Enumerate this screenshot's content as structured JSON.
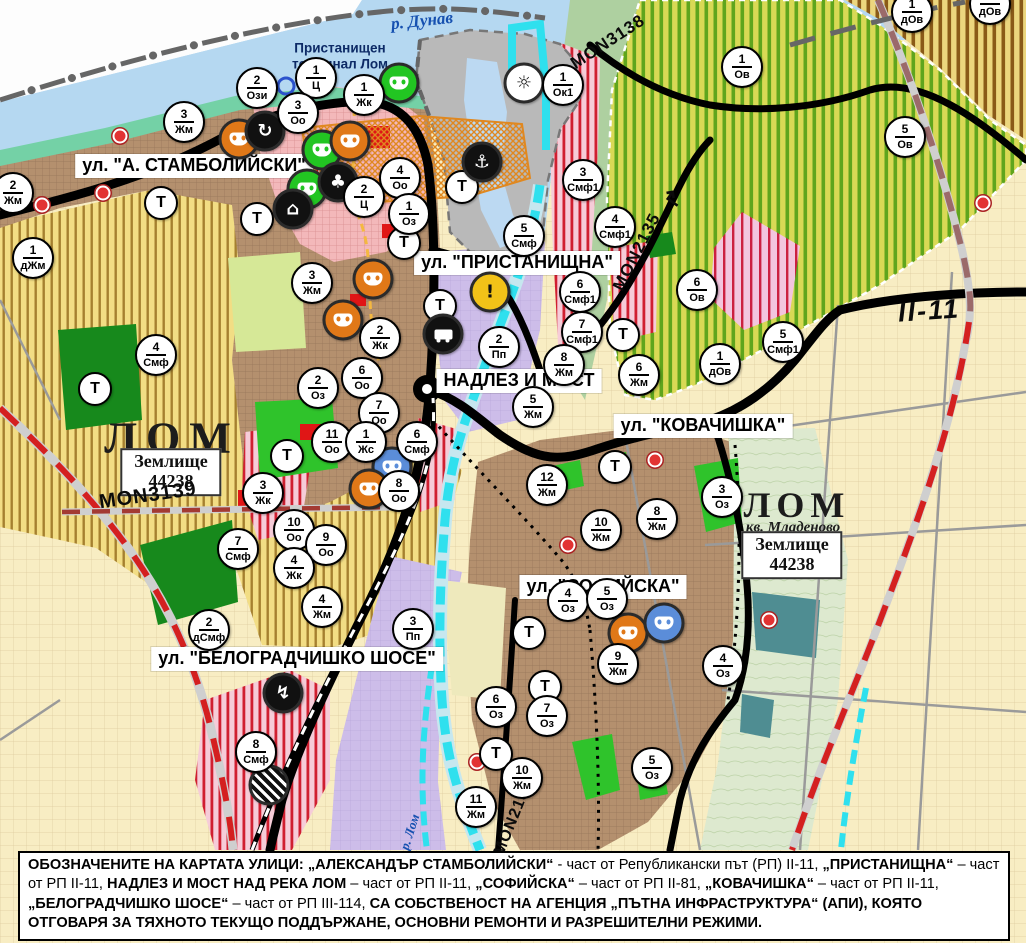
{
  "map_meta": {
    "danube_label": "р. Дунав",
    "river_lom_label": "р. Лом",
    "port_label_line1": "Пристанищен",
    "port_label_line2": "терминал Лом",
    "city_west": "ЛОМ",
    "city_east": "ЛОМ",
    "quarter_east": "кв. Младеново",
    "landplot_line1": "Землище",
    "landplot_line2": "44238",
    "t_symbol": "Т"
  },
  "street_labels": [
    {
      "text": "ул. \"А. СТАМБОЛИЙСКИ\"",
      "x": 194,
      "y": 166
    },
    {
      "text": "ул. \"ПРИСТАНИЩНА\"",
      "x": 517,
      "y": 263
    },
    {
      "text": "НАДЛЕЗ И МОСТ",
      "x": 519,
      "y": 381
    },
    {
      "text": "ул. \"КОВАЧИШКА\"",
      "x": 703,
      "y": 426
    },
    {
      "text": "ул. \"СОФИЙСКА\"",
      "x": 603,
      "y": 587
    },
    {
      "text": "ул. \"БЕЛОГРАДЧИШКО ШОСЕ\"",
      "x": 297,
      "y": 659
    }
  ],
  "road_labels": [
    {
      "text": "MON3138",
      "x": 608,
      "y": 42,
      "rot": -33,
      "size": 17
    },
    {
      "text": "MON2135",
      "x": 637,
      "y": 252,
      "rot": -63,
      "size": 17
    },
    {
      "text": "↱",
      "x": 674,
      "y": 198,
      "rot": -55,
      "size": 22
    },
    {
      "text": "MON3139",
      "x": 148,
      "y": 496,
      "rot": -8,
      "size": 20
    },
    {
      "text": "MON2136",
      "x": 514,
      "y": 818,
      "rot": -68,
      "size": 16
    },
    {
      "text": "II-11",
      "x": 929,
      "y": 311,
      "rot": -4,
      "size": 27,
      "big": true
    }
  ],
  "zone_markers": [
    {
      "num": "2",
      "code": "Жм",
      "x": 13,
      "y": 193
    },
    {
      "num": "3",
      "code": "Жм",
      "x": 184,
      "y": 122
    },
    {
      "num": "2",
      "code": "Ози",
      "x": 257,
      "y": 88
    },
    {
      "num": "1",
      "code": "Ц",
      "x": 316,
      "y": 78
    },
    {
      "num": "3",
      "code": "Оо",
      "x": 298,
      "y": 113
    },
    {
      "num": "1",
      "code": "Жк",
      "x": 364,
      "y": 95
    },
    {
      "num": "4",
      "code": "Оо",
      "x": 400,
      "y": 178
    },
    {
      "num": "2",
      "code": "Ц",
      "x": 364,
      "y": 197
    },
    {
      "num": "1",
      "code": "Оз",
      "x": 409,
      "y": 214
    },
    {
      "num": "1",
      "code": "Ок1",
      "x": 563,
      "y": 85
    },
    {
      "num": "3",
      "code": "Смф1",
      "x": 583,
      "y": 180
    },
    {
      "num": "4",
      "code": "Смф1",
      "x": 615,
      "y": 227
    },
    {
      "num": "5",
      "code": "Смф",
      "x": 524,
      "y": 236
    },
    {
      "num": "6",
      "code": "Смф1",
      "x": 580,
      "y": 292
    },
    {
      "num": "7",
      "code": "Смф1",
      "x": 582,
      "y": 332
    },
    {
      "num": "6",
      "code": "Ов",
      "x": 697,
      "y": 290
    },
    {
      "num": "1",
      "code": "Ов",
      "x": 742,
      "y": 67
    },
    {
      "num": "5",
      "code": "Ов",
      "x": 905,
      "y": 137
    },
    {
      "num": "1",
      "code": "дОв",
      "x": 912,
      "y": 12
    },
    {
      "num": "1",
      "code": "дОв",
      "x": 990,
      "y": 4
    },
    {
      "num": "1",
      "code": "дЖм",
      "x": 33,
      "y": 258
    },
    {
      "num": "4",
      "code": "Смф",
      "x": 156,
      "y": 355
    },
    {
      "num": "3",
      "code": "Жм",
      "x": 312,
      "y": 283
    },
    {
      "num": "2",
      "code": "Жк",
      "x": 380,
      "y": 338
    },
    {
      "num": "6",
      "code": "Оо",
      "x": 362,
      "y": 378
    },
    {
      "num": "2",
      "code": "Оз",
      "x": 318,
      "y": 388
    },
    {
      "num": "7",
      "code": "Оо",
      "x": 379,
      "y": 413
    },
    {
      "num": "11",
      "code": "Оо",
      "x": 332,
      "y": 442
    },
    {
      "num": "1",
      "code": "Жс",
      "x": 366,
      "y": 442
    },
    {
      "num": "6",
      "code": "Смф",
      "x": 417,
      "y": 442
    },
    {
      "num": "8",
      "code": "Оо",
      "x": 399,
      "y": 491
    },
    {
      "num": "3",
      "code": "Жк",
      "x": 263,
      "y": 493
    },
    {
      "num": "2",
      "code": "Пп",
      "x": 499,
      "y": 347
    },
    {
      "num": "5",
      "code": "Жм",
      "x": 533,
      "y": 407
    },
    {
      "num": "8",
      "code": "Жм",
      "x": 564,
      "y": 365
    },
    {
      "num": "6",
      "code": "Жм",
      "x": 639,
      "y": 375
    },
    {
      "num": "1",
      "code": "дОв",
      "x": 720,
      "y": 364
    },
    {
      "num": "5",
      "code": "Смф1",
      "x": 783,
      "y": 342
    },
    {
      "num": "10",
      "code": "Оо",
      "x": 294,
      "y": 530
    },
    {
      "num": "9",
      "code": "Оо",
      "x": 326,
      "y": 545
    },
    {
      "num": "4",
      "code": "Жк",
      "x": 294,
      "y": 568
    },
    {
      "num": "7",
      "code": "Смф",
      "x": 238,
      "y": 549
    },
    {
      "num": "4",
      "code": "Жм",
      "x": 322,
      "y": 607
    },
    {
      "num": "3",
      "code": "Пп",
      "x": 413,
      "y": 629
    },
    {
      "num": "2",
      "code": "дСмф",
      "x": 209,
      "y": 630
    },
    {
      "num": "8",
      "code": "Смф",
      "x": 256,
      "y": 752
    },
    {
      "num": "12",
      "code": "Жм",
      "x": 547,
      "y": 485
    },
    {
      "num": "10",
      "code": "Жм",
      "x": 601,
      "y": 530
    },
    {
      "num": "8",
      "code": "Жм",
      "x": 657,
      "y": 519
    },
    {
      "num": "3",
      "code": "Оз",
      "x": 722,
      "y": 497
    },
    {
      "num": "9",
      "code": "Жм",
      "x": 618,
      "y": 664
    },
    {
      "num": "4",
      "code": "Оз",
      "x": 723,
      "y": 666
    },
    {
      "num": "4",
      "code": "Оз",
      "x": 568,
      "y": 601
    },
    {
      "num": "5",
      "code": "Оз",
      "x": 607,
      "y": 599
    },
    {
      "num": "6",
      "code": "Оз",
      "x": 496,
      "y": 707
    },
    {
      "num": "7",
      "code": "Оз",
      "x": 547,
      "y": 716
    },
    {
      "num": "5",
      "code": "Оз",
      "x": 652,
      "y": 768
    },
    {
      "num": "10",
      "code": "Жм",
      "x": 522,
      "y": 778
    },
    {
      "num": "11",
      "code": "Жм",
      "x": 476,
      "y": 807
    }
  ],
  "t_markers": [
    {
      "x": 161,
      "y": 203
    },
    {
      "x": 257,
      "y": 219
    },
    {
      "x": 404,
      "y": 243
    },
    {
      "x": 462,
      "y": 187
    },
    {
      "x": 440,
      "y": 306
    },
    {
      "x": 623,
      "y": 335
    },
    {
      "x": 95,
      "y": 389
    },
    {
      "x": 287,
      "y": 456
    },
    {
      "x": 615,
      "y": 467
    },
    {
      "x": 529,
      "y": 633
    },
    {
      "x": 545,
      "y": 687
    },
    {
      "x": 496,
      "y": 754
    }
  ],
  "icon_markers": [
    {
      "icon": "culture-mask",
      "glyph": "",
      "bg": "#e07818",
      "x": 239,
      "y": 139
    },
    {
      "icon": "roundabout",
      "glyph": "↻",
      "bg": "#111111",
      "x": 265,
      "y": 131
    },
    {
      "icon": "culture-mask",
      "glyph": "",
      "bg": "#22c522",
      "x": 322,
      "y": 150
    },
    {
      "icon": "culture-mask",
      "glyph": "",
      "bg": "#e07818",
      "x": 350,
      "y": 141
    },
    {
      "icon": "culture-mask",
      "glyph": "",
      "bg": "#22c522",
      "x": 307,
      "y": 189
    },
    {
      "icon": "trefoil",
      "glyph": "♣",
      "bg": "#111111",
      "x": 338,
      "y": 182
    },
    {
      "icon": "tumulus",
      "glyph": "⌂",
      "bg": "#111111",
      "x": 293,
      "y": 209
    },
    {
      "icon": "culture-mask",
      "glyph": "",
      "bg": "#22c522",
      "x": 399,
      "y": 83
    },
    {
      "icon": "anchor-port",
      "glyph": "⚓",
      "bg": "#111111",
      "x": 482,
      "y": 162
    },
    {
      "icon": "sunrise",
      "glyph": "☼",
      "bg": "#ffffff",
      "x": 524,
      "y": 83,
      "fg": "#111"
    },
    {
      "icon": "warning",
      "glyph": "!",
      "bg": "#f2c218",
      "x": 490,
      "y": 292,
      "fg": "#111"
    },
    {
      "icon": "truck-depot",
      "glyph": "",
      "bg": "#111111",
      "x": 443,
      "y": 334
    },
    {
      "icon": "culture-mask",
      "glyph": "",
      "bg": "#e07818",
      "x": 373,
      "y": 279
    },
    {
      "icon": "culture-mask",
      "glyph": "",
      "bg": "#e07818",
      "x": 343,
      "y": 320
    },
    {
      "icon": "culture-mask",
      "glyph": "",
      "bg": "#5b8dd9",
      "x": 392,
      "y": 467
    },
    {
      "icon": "culture-mask",
      "glyph": "",
      "bg": "#e07818",
      "x": 369,
      "y": 489
    },
    {
      "icon": "culture-mask",
      "glyph": "",
      "bg": "#e07818",
      "x": 628,
      "y": 633
    },
    {
      "icon": "culture-mask",
      "glyph": "",
      "bg": "#5b8dd9",
      "x": 664,
      "y": 623
    },
    {
      "icon": "power",
      "glyph": "↯",
      "bg": "#111111",
      "x": 283,
      "y": 693
    },
    {
      "icon": "quarry-hatch",
      "glyph": "",
      "bg": "#111111",
      "x": 269,
      "y": 785
    }
  ],
  "point_markers": [
    {
      "kind": "red-dot",
      "x": 120,
      "y": 136
    },
    {
      "kind": "red-dot",
      "x": 103,
      "y": 193
    },
    {
      "kind": "red-dot",
      "x": 42,
      "y": 205
    },
    {
      "kind": "red-dot",
      "x": 655,
      "y": 460
    },
    {
      "kind": "red-dot",
      "x": 568,
      "y": 545
    },
    {
      "kind": "red-dot",
      "x": 769,
      "y": 620
    },
    {
      "kind": "red-dot",
      "x": 477,
      "y": 762
    },
    {
      "kind": "red-dot",
      "x": 983,
      "y": 203
    },
    {
      "kind": "blue-ring",
      "x": 286,
      "y": 86
    }
  ],
  "footer": {
    "segments": [
      {
        "bold": true,
        "text": "ОБОЗНАЧЕНИТЕ НА КАРТАТА УЛИЦИ: „АЛЕКСАНДЪР СТАМБОЛИЙСКИ“"
      },
      {
        "bold": false,
        "text": " - част от Републикански път (РП) II-11, "
      },
      {
        "bold": true,
        "text": "„ПРИСТАНИЩНА“"
      },
      {
        "bold": false,
        "text": " – част от РП II-11, "
      },
      {
        "bold": true,
        "text": "НАДЛЕЗ И МОСТ НАД РЕКА ЛОМ"
      },
      {
        "bold": false,
        "text": " – част от РП II-11, "
      },
      {
        "bold": true,
        "text": "„СОФИЙСКА“"
      },
      {
        "bold": false,
        "text": " – част от РП II-81, "
      },
      {
        "bold": true,
        "text": "„КОВАЧИШКА“"
      },
      {
        "bold": false,
        "text": " – част от РП II-11, "
      },
      {
        "bold": true,
        "text": "„БЕЛОГРАДЧИШКО ШОСЕ“"
      },
      {
        "bold": false,
        "text": " – част от РП III-114, "
      },
      {
        "bold": true,
        "text": "СА СОБСТВЕНОСТ НА АГЕНЦИЯ „ПЪТНА ИНФРАСТРУКТУРА“ (АПИ), КОЯТО ОТГОВАРЯ ЗА ТЯХНОТО ТЕКУЩО ПОДДЪРЖАНЕ, ОСНОВНИ РЕМОНТИ И РАЗРЕШИТЕЛНИ РЕЖИМИ."
      }
    ]
  },
  "colors": {
    "water": "#b5d8f1",
    "shore_green": "#74d1a6",
    "urban_brown": "#b4906e",
    "farm_yellow": "#f2dd84",
    "vineyard": "#d9d955",
    "smf_stripe_red": "#d01f30",
    "lavender": "#cdbde9",
    "cream": "#f8edc3",
    "park_green": "#17891c",
    "bright_green": "#2fc32b",
    "port_gray": "#b9b9b9",
    "road_black": "#000000",
    "ring_red": "#d42020",
    "river_cyan": "#2fe0ee"
  }
}
